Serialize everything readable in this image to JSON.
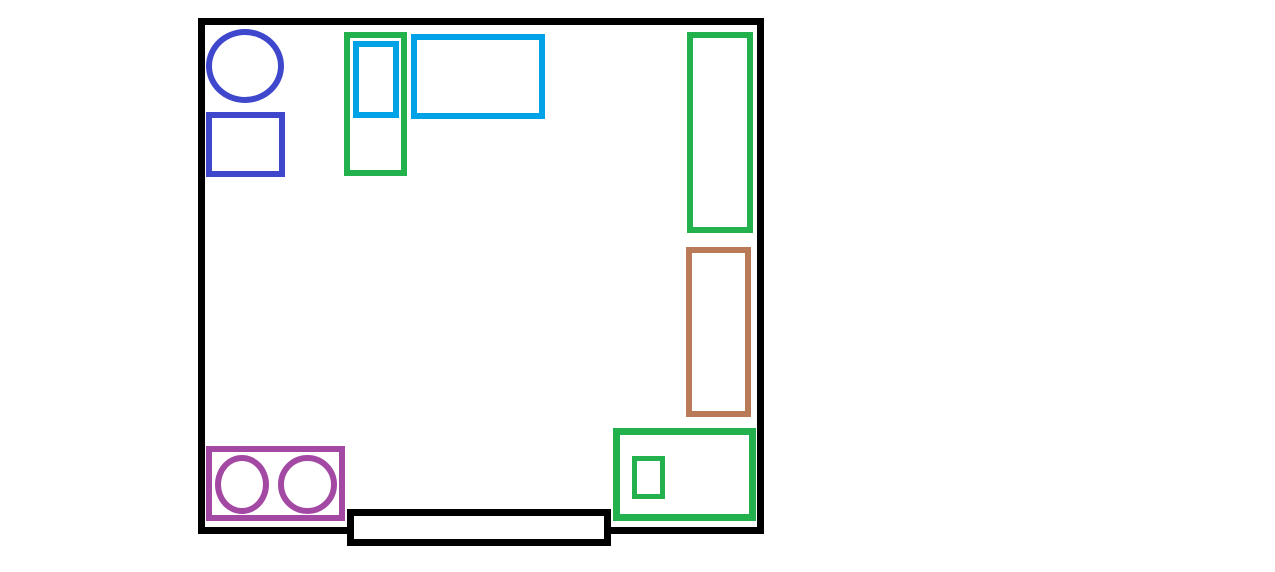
{
  "canvas": {
    "width": 1275,
    "height": 572,
    "background": "#FFFFFF",
    "description": "Paint-style floor plan drawing of a square room with colored outlined shapes and a door across the bottom wall"
  },
  "palette": {
    "black": "#000000",
    "indigo": "#3F48CC",
    "green": "#22B14C",
    "turquoise": "#00A2E8",
    "brown": "#B97A57",
    "purple": "#A349A4",
    "white": "#FFFFFF"
  },
  "shapes": [
    {
      "name": "room-wall-outline",
      "type": "rect",
      "color": "black",
      "fill": "none",
      "x": 198,
      "y": 18,
      "w": 566,
      "h": 516,
      "stroke": 7,
      "z": 1
    },
    {
      "name": "blue-circle-top-left",
      "type": "ellipse",
      "color": "indigo",
      "fill": "none",
      "x": 206,
      "y": 29,
      "w": 78,
      "h": 74,
      "stroke": 6,
      "z": 2
    },
    {
      "name": "blue-rectangle-top-left",
      "type": "rect",
      "color": "indigo",
      "fill": "none",
      "x": 206,
      "y": 112,
      "w": 79,
      "h": 65,
      "stroke": 6,
      "z": 2
    },
    {
      "name": "green-tall-rectangle-left",
      "type": "rect",
      "color": "green",
      "fill": "none",
      "x": 344,
      "y": 32,
      "w": 63,
      "h": 144,
      "stroke": 6,
      "z": 2
    },
    {
      "name": "turquoise-small-rectangle",
      "type": "rect",
      "color": "turquoise",
      "fill": "none",
      "x": 353,
      "y": 41,
      "w": 46,
      "h": 77,
      "stroke": 6,
      "z": 3
    },
    {
      "name": "turquoise-wide-rectangle",
      "type": "rect",
      "color": "turquoise",
      "fill": "none",
      "x": 411,
      "y": 34,
      "w": 134,
      "h": 85,
      "stroke": 6,
      "z": 2
    },
    {
      "name": "green-tall-rectangle-right",
      "type": "rect",
      "color": "green",
      "fill": "none",
      "x": 687,
      "y": 32,
      "w": 66,
      "h": 201,
      "stroke": 6,
      "z": 2
    },
    {
      "name": "brown-rectangle-right",
      "type": "rect",
      "color": "brown",
      "fill": "none",
      "x": 686,
      "y": 247,
      "w": 65,
      "h": 170,
      "stroke": 6,
      "z": 2
    },
    {
      "name": "green-rectangle-bottom-right",
      "type": "rect",
      "color": "green",
      "fill": "none",
      "x": 613,
      "y": 428,
      "w": 143,
      "h": 93,
      "stroke": 7,
      "z": 2
    },
    {
      "name": "green-small-box-inside",
      "type": "rect",
      "color": "green",
      "fill": "none",
      "x": 632,
      "y": 456,
      "w": 33,
      "h": 43,
      "stroke": 5,
      "z": 3
    },
    {
      "name": "purple-rectangle-bottom-left",
      "type": "rect",
      "color": "purple",
      "fill": "none",
      "x": 206,
      "y": 446,
      "w": 139,
      "h": 75,
      "stroke": 6,
      "z": 2
    },
    {
      "name": "purple-circle-left-burner",
      "type": "ellipse",
      "color": "purple",
      "fill": "none",
      "x": 215,
      "y": 455,
      "w": 54,
      "h": 59,
      "stroke": 6,
      "z": 3
    },
    {
      "name": "purple-circle-right-burner",
      "type": "ellipse",
      "color": "purple",
      "fill": "none",
      "x": 278,
      "y": 455,
      "w": 59,
      "h": 59,
      "stroke": 6,
      "z": 3
    },
    {
      "name": "black-door-rectangle",
      "type": "rect",
      "color": "black",
      "fill": "white",
      "x": 347,
      "y": 509,
      "w": 264,
      "h": 37,
      "stroke": 7,
      "z": 4
    }
  ]
}
